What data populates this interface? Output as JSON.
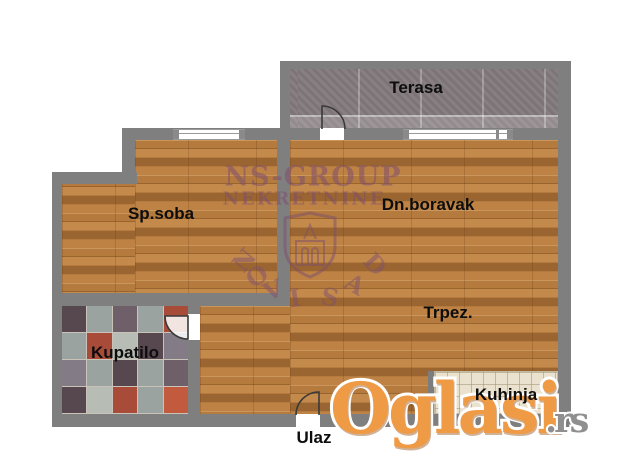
{
  "rooms": {
    "terasa": "Terasa",
    "sp_soba": "Sp.soba",
    "dn_boravak": "Dn.boravak",
    "trpez": "Trpez.",
    "kupatilo": "Kupatilo",
    "kuhinja": "Kuhinja",
    "ulaz": "Ulaz"
  },
  "watermarks": {
    "agency": {
      "line1": "NS-GROUP",
      "line2": "NEKRETNINE",
      "city": "NOVI SAD",
      "city_letters": [
        "N",
        "O",
        "V",
        "I",
        "S",
        "A",
        "D"
      ],
      "color": "#7d4f6d"
    },
    "site": {
      "name": "Oglasi",
      "tld": ".rs",
      "orange": "#ef9a45",
      "gray": "#8f8f8f"
    }
  },
  "colors": {
    "wall": "#7f7f7f",
    "wood_base": "#b57a3d",
    "terrace_base": "#8b8285",
    "kitchen_tile": "#eae2ce",
    "bath_palette": [
      "#9aa3a0",
      "#57474f",
      "#a84c39",
      "#837b85",
      "#b7bcb4",
      "#6e5f68",
      "#c25b3e"
    ]
  }
}
